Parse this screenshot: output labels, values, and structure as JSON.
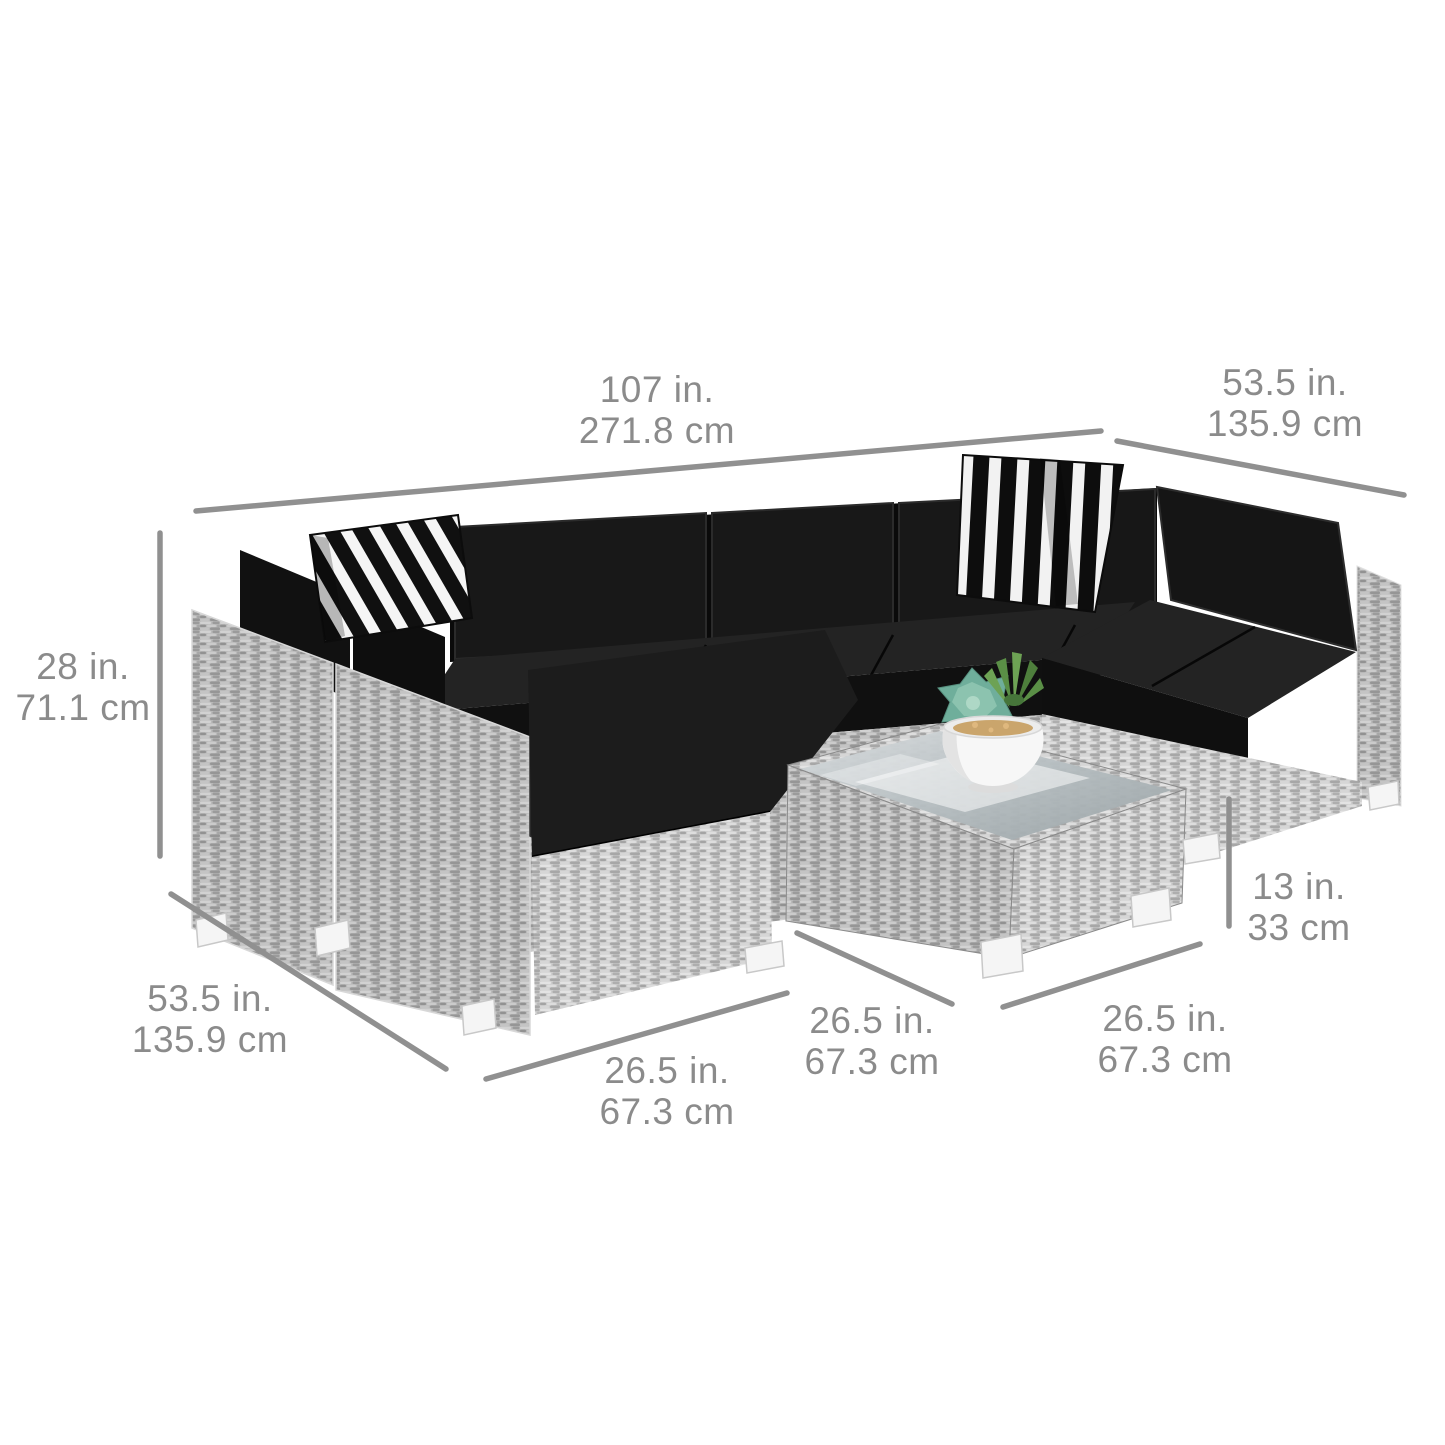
{
  "scene": {
    "objects": [
      "wicker-sectional-sofa",
      "striped-throw-pillow-left",
      "striped-throw-pillow-right",
      "wicker-coffee-table-glass-top",
      "succulent-planter"
    ]
  },
  "dimensions": [
    {
      "id": "sofa-back-width",
      "lines": [
        "107 in.",
        "271.8 cm"
      ]
    },
    {
      "id": "sofa-depth-right",
      "lines": [
        "53.5 in.",
        "135.9 cm"
      ]
    },
    {
      "id": "sofa-height",
      "lines": [
        "28 in.",
        "71.1 cm"
      ]
    },
    {
      "id": "sofa-depth-left",
      "lines": [
        "53.5 in.",
        "135.9 cm"
      ]
    },
    {
      "id": "seat-module-width",
      "lines": [
        "26.5 in.",
        "67.3 cm"
      ]
    },
    {
      "id": "table-side-left",
      "lines": [
        "26.5 in.",
        "67.3 cm"
      ]
    },
    {
      "id": "table-side-right",
      "lines": [
        "26.5 in.",
        "67.3 cm"
      ]
    },
    {
      "id": "table-height",
      "lines": [
        "13 in.",
        "33 cm"
      ]
    }
  ],
  "colors": {
    "label_color": "#8b8b8b",
    "line_color": "#909090",
    "cushion_black": "#1a1a1a",
    "wicker_gray": "#bdbdbd",
    "pillow_stripe_dark": "#101010",
    "pillow_stripe_light": "#f5f5f5",
    "foot_white": "#f5f5f5",
    "pot_white": "#f7f7f7",
    "succulent_teal": "#6fae9b",
    "succulent_green": "#5a8f46",
    "background": "#ffffff"
  }
}
